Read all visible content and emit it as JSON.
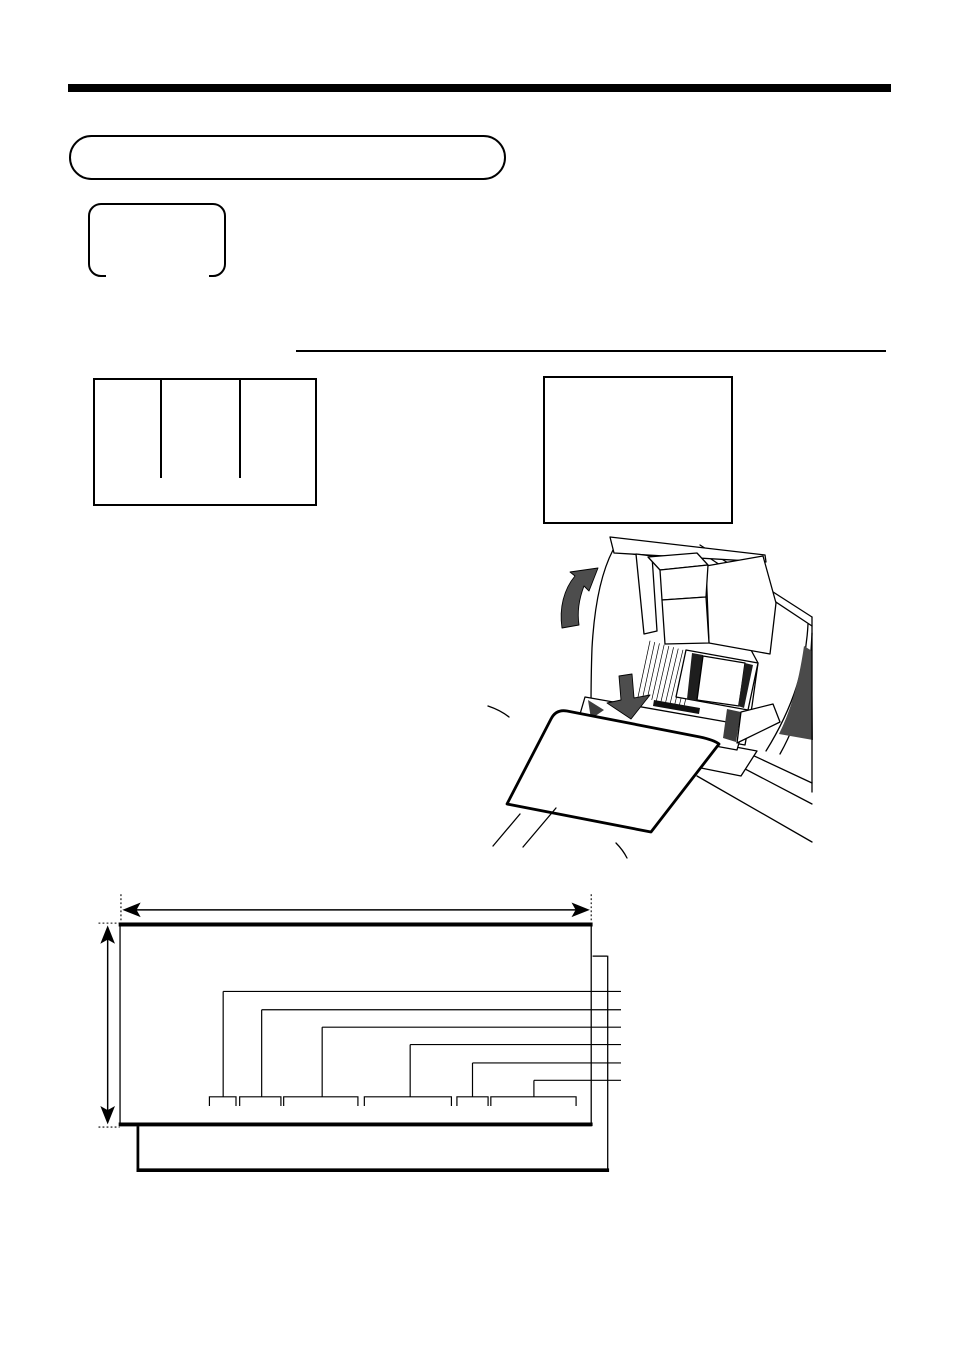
{
  "page": {
    "kind": "scanned-manual-page",
    "background": "#ffffff",
    "note": "page contains only line-art; no rendered text is visible"
  },
  "colors": {
    "ink": "#000000",
    "arrow_gray": "#4d4d4d",
    "window_gray": "#4a4a4a",
    "slot_dark": "#3d3d3d",
    "platen_dark": "#1e1e1e"
  },
  "header": {
    "rule": {
      "x": 68,
      "y": 84,
      "width": 823,
      "height": 8
    },
    "title_pill": {
      "x": 69,
      "y": 135,
      "width": 438,
      "height": 46
    }
  },
  "key_cap": {
    "x": 88,
    "y": 203,
    "width": 139,
    "height": 75,
    "bottom_edge": "open-center"
  },
  "display_box": {
    "x": 93,
    "y": 378,
    "width": 225,
    "height": 129,
    "column_dividers_x": [
      66,
      145
    ],
    "divider_height": 98
  },
  "note_box": {
    "x": 543,
    "y": 376,
    "width": 190,
    "height": 148
  },
  "mid_divider_line": {
    "x1": 296,
    "x2": 886,
    "y": 351
  },
  "printer_illustration": {
    "elements": [
      "open-print-cover",
      "ribbon-fan",
      "platen-roller",
      "validation-slip",
      "curved-up-arrow",
      "down-arrow",
      "dark-side-window",
      "register-body"
    ],
    "ribbon_fan_line_count": 11
  },
  "slip_diagram": {
    "main_sheet": {
      "x1": 125,
      "y1": 912,
      "x2": 640,
      "y2": 1134
    },
    "second_sheet": {
      "x1": 145,
      "y1": 948,
      "x2": 657,
      "y2": 1183
    },
    "width_arrow": {
      "y": 898,
      "x1": 130,
      "x2": 637
    },
    "height_arrow": {
      "x": 112,
      "y1": 916,
      "y2": 1131
    },
    "leader_line_end_x": 672,
    "leaders": [
      {
        "y": 987,
        "x_start": 238
      },
      {
        "y": 1007,
        "x_start": 280
      },
      {
        "y": 1026,
        "x_start": 346
      },
      {
        "y": 1045,
        "x_start": 442
      },
      {
        "y": 1065,
        "x_start": 510
      },
      {
        "y": 1084,
        "x_start": 577
      }
    ],
    "bracket_y": 1102,
    "bracket_tick_drop": 10,
    "brackets": [
      {
        "x1": 223,
        "x2": 252
      },
      {
        "x1": 256,
        "x2": 301
      },
      {
        "x1": 304,
        "x2": 385
      },
      {
        "x1": 392,
        "x2": 487
      },
      {
        "x1": 493,
        "x2": 527
      },
      {
        "x1": 530,
        "x2": 623
      }
    ]
  }
}
